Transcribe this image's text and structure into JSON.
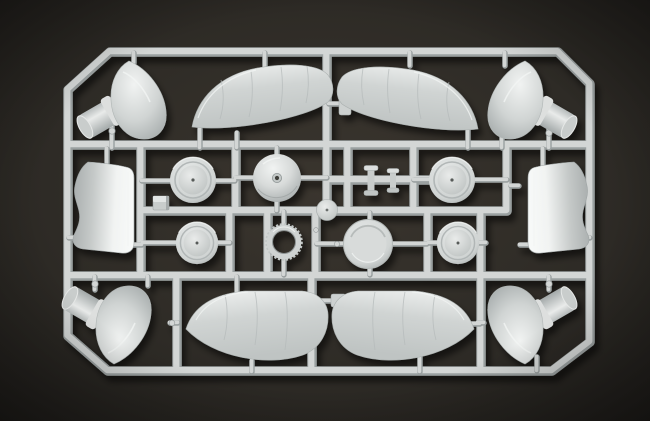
{
  "scene": {
    "subject": "light gray injection-molded plastic model kit sprue (parts frame) with aircraft components",
    "background": "dark brown studio surface with corner vignette",
    "part_count": 21
  },
  "palette": {
    "background_center": "#3a352e",
    "background_mid": "#2e2b26",
    "background_edge": "#201e1b",
    "plastic_base": "#d0d4d3",
    "plastic_highlight": "#f1f3f2",
    "plastic_shadow": "#a3a9a9",
    "runner_face": "#d3d6d5",
    "runner_shadow": "#9aa0a0",
    "cast_shadow": "rgba(0,0,0,0.55)"
  },
  "sprue": {
    "frame_shape": "octagon (rectangle with chamfered corners)",
    "parts": [
      {
        "name": "wheel-spat-top-left",
        "type": "teardrop fairing with stub cylinder"
      },
      {
        "name": "wing-upper-left",
        "type": "wing half with panel lines"
      },
      {
        "name": "wing-upper-right",
        "type": "wing half with panel lines"
      },
      {
        "name": "wheel-spat-top-right",
        "type": "teardrop fairing with stub cylinder"
      },
      {
        "name": "cowl-panel-left",
        "type": "curved fuselage panel"
      },
      {
        "name": "wheel-disc-upper-left",
        "type": "round disc with center pip"
      },
      {
        "name": "spinner-dome",
        "type": "domed spinner with center hole"
      },
      {
        "name": "spool-small-left",
        "type": "small flanged cylinder"
      },
      {
        "name": "spool-small-right",
        "type": "small flanged cylinder"
      },
      {
        "name": "wheel-disc-upper-right",
        "type": "round disc with center pip"
      },
      {
        "name": "cowl-panel-right",
        "type": "curved fuselage panel"
      },
      {
        "name": "small-dome-part",
        "type": "small disc with stem"
      },
      {
        "name": "tab-block",
        "type": "small rectangular block"
      },
      {
        "name": "wheel-disc-lower-left",
        "type": "round disc with center pip"
      },
      {
        "name": "cooling-fan-ring",
        "type": "toothed open ring"
      },
      {
        "name": "recessed-hub-disc",
        "type": "flat recessed disc"
      },
      {
        "name": "wheel-disc-lower-right",
        "type": "round disc with center pip"
      },
      {
        "name": "wheel-spat-bottom-left",
        "type": "teardrop fairing with stub cylinder"
      },
      {
        "name": "wing-lower-left",
        "type": "wing half with panel lines"
      },
      {
        "name": "wing-lower-right",
        "type": "wing half with panel lines"
      },
      {
        "name": "wheel-spat-bottom-right",
        "type": "teardrop fairing with stub cylinder"
      }
    ]
  }
}
